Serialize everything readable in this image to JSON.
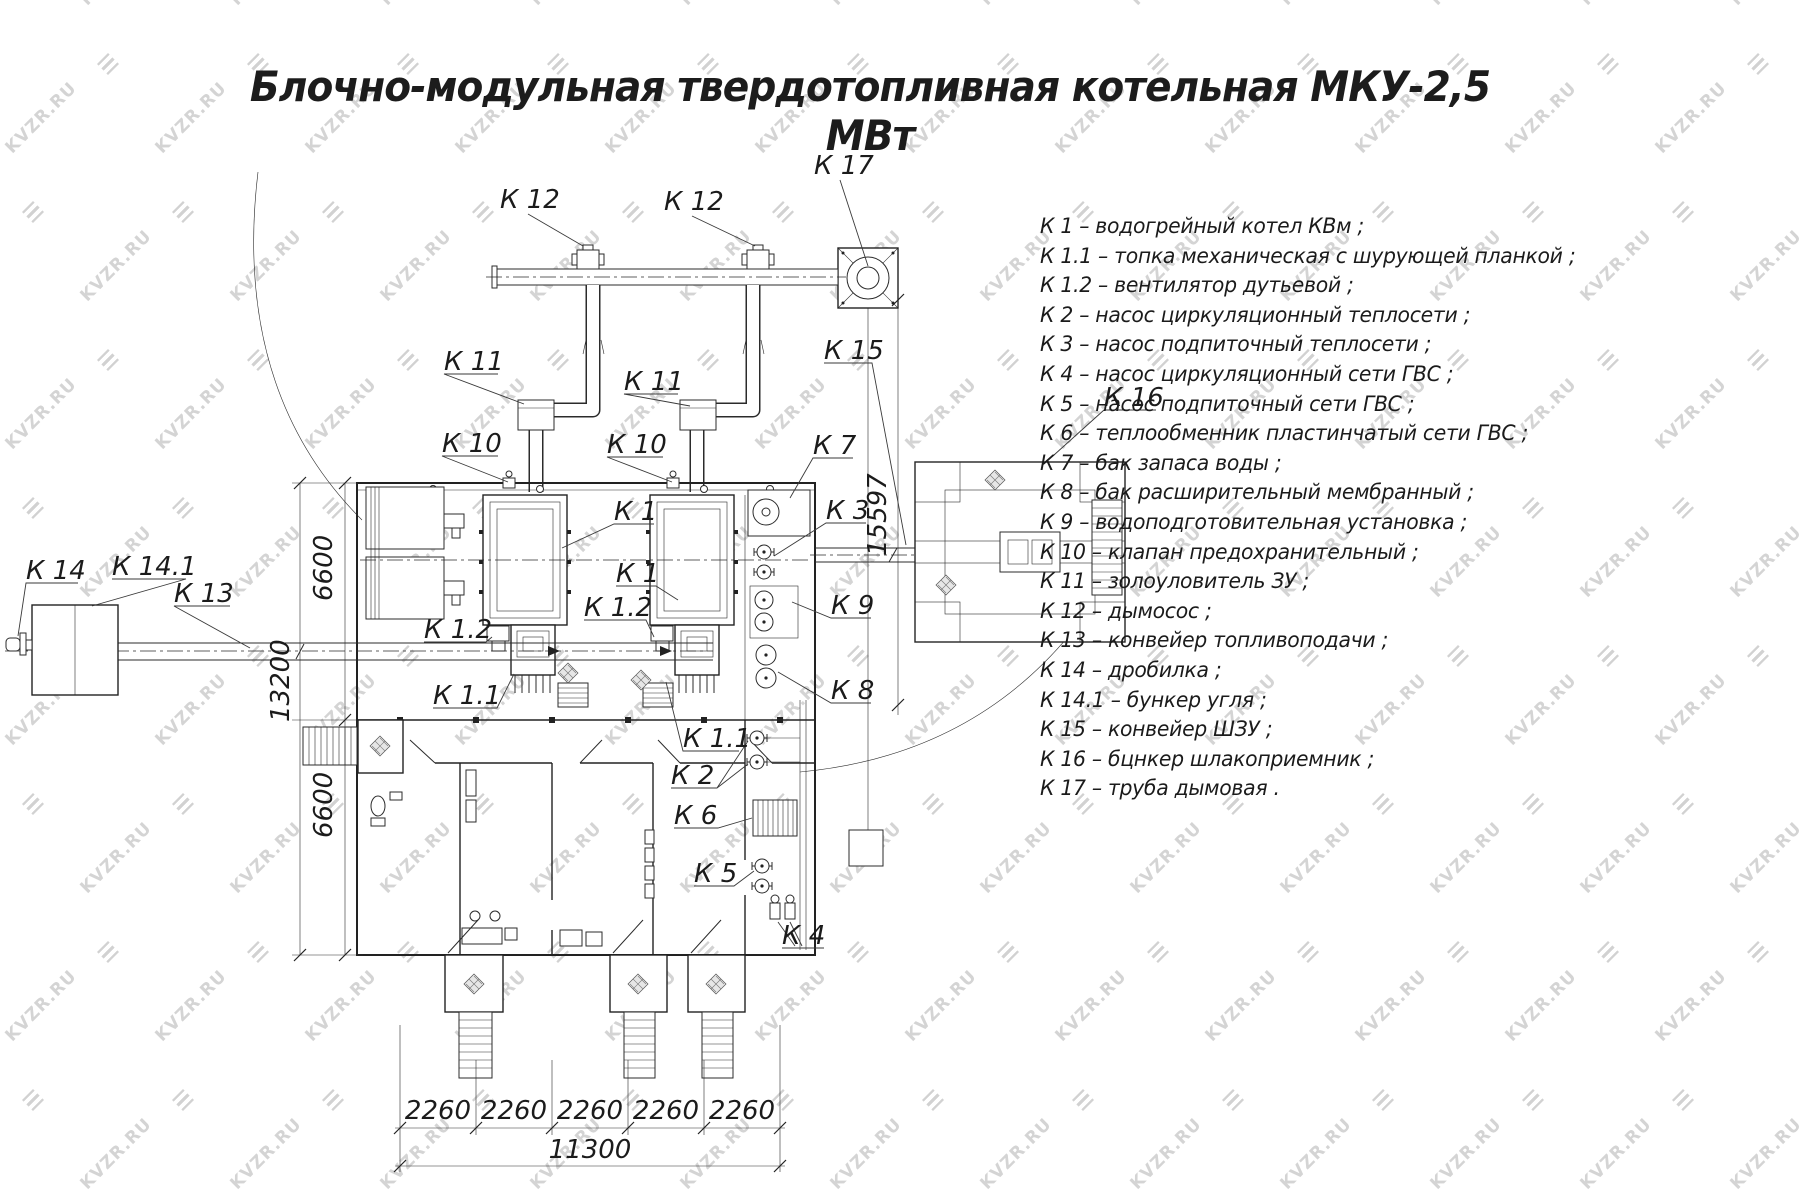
{
  "title": "Блочно-модульная твердотопливная котельная МКУ-2,5 МВт",
  "watermark": {
    "text": "KVZR.RU",
    "logo": "kvzr-stripe-diamond"
  },
  "legend": {
    "items": [
      "К 1  –   водогрейный котел КВм ;",
      "К 1.1  –   топка механическая с шурующей планкой ;",
      "К 1.2  –   вентилятор дутьевой ;",
      "К 2  –   насос циркуляционный теплосети ;",
      "К 3  –   насос подпиточный теплосети ;",
      "К 4  –   насос циркуляционный сети ГВС ;",
      "К 5  –   насос подпиточный сети ГВС ;",
      "К 6  –   теплообменник пластинчатый сети ГВС ;",
      "К 7  –   бак запаса воды ;",
      "К 8  –   бак расширительный мембранный ;",
      "К 9  –   водоподготовительная установка ;",
      "К 10  –   клапан предохранительный ;",
      "К 11  –   золоуловитель ЗУ ;",
      "К 12  –   дымосос ;",
      "К 13  –   конвейер топливоподачи ;",
      "К 14  –   дробилка ;",
      "К 14.1  –   бункер угля ;",
      "К 15  –   конвейер ШЗУ ;",
      "К 16  –   бцнкер шлакоприемник ;",
      "К 17  –   труба дымовая ."
    ]
  },
  "drawing": {
    "labels": [
      {
        "t": "К 12",
        "x": 500,
        "y": 208
      },
      {
        "t": "К 12",
        "x": 664,
        "y": 210
      },
      {
        "t": "К 17",
        "x": 814,
        "y": 174
      },
      {
        "t": "К 11",
        "x": 444,
        "y": 370
      },
      {
        "t": "К 11",
        "x": 624,
        "y": 390
      },
      {
        "t": "К 10",
        "x": 442,
        "y": 452
      },
      {
        "t": "К 10",
        "x": 607,
        "y": 453
      },
      {
        "t": "К 1",
        "x": 614,
        "y": 520
      },
      {
        "t": "К 1",
        "x": 616,
        "y": 582
      },
      {
        "t": "К 1.2",
        "x": 424,
        "y": 638
      },
      {
        "t": "К 1.2",
        "x": 584,
        "y": 616
      },
      {
        "t": "К 1.1",
        "x": 433,
        "y": 704
      },
      {
        "t": "К 1.1",
        "x": 683,
        "y": 747
      },
      {
        "t": "К 2",
        "x": 671,
        "y": 784
      },
      {
        "t": "К 6",
        "x": 674,
        "y": 824
      },
      {
        "t": "К 5",
        "x": 694,
        "y": 882
      },
      {
        "t": "К 4",
        "x": 782,
        "y": 944
      },
      {
        "t": "К 7",
        "x": 813,
        "y": 454
      },
      {
        "t": "К 3",
        "x": 826,
        "y": 519
      },
      {
        "t": "К 9",
        "x": 831,
        "y": 614
      },
      {
        "t": "К 8",
        "x": 831,
        "y": 699
      },
      {
        "t": "К 13",
        "x": 174,
        "y": 602
      },
      {
        "t": "К 14",
        "x": 26,
        "y": 579
      },
      {
        "t": "К 14.1",
        "x": 112,
        "y": 575
      },
      {
        "t": "К 15",
        "x": 824,
        "y": 359
      },
      {
        "t": "К 16",
        "x": 1104,
        "y": 406
      },
      {
        "t": "6600",
        "x": 332,
        "y": 601,
        "r": -90
      },
      {
        "t": "13200",
        "x": 289,
        "y": 722,
        "r": -90
      },
      {
        "t": "6600",
        "x": 332,
        "y": 838,
        "r": -90
      },
      {
        "t": "15597",
        "x": 886,
        "y": 556,
        "r": -90
      },
      {
        "t": "2260",
        "x": 438,
        "y": 1119,
        "a": "m"
      },
      {
        "t": "2260",
        "x": 514,
        "y": 1119,
        "a": "m"
      },
      {
        "t": "2260",
        "x": 590,
        "y": 1119,
        "a": "m"
      },
      {
        "t": "2260",
        "x": 666,
        "y": 1119,
        "a": "m"
      },
      {
        "t": "2260",
        "x": 742,
        "y": 1119,
        "a": "m"
      },
      {
        "t": "11300",
        "x": 590,
        "y": 1158,
        "a": "m"
      }
    ]
  }
}
